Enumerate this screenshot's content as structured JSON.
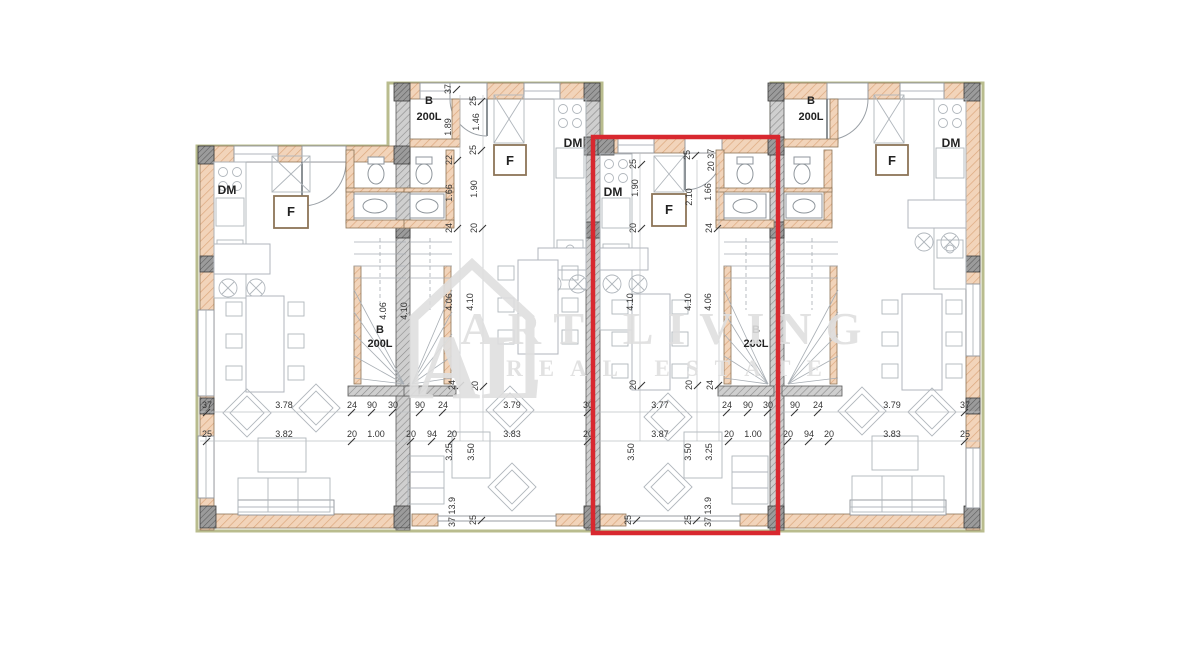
{
  "palette": {
    "highlight_red": "#d8282f",
    "wall_fill": "#f2d4ba",
    "wall_hatch": "#dca87e",
    "party_wall_gray": "#cfcfcf",
    "column_gray": "#9b9b9b",
    "olive_outline": "#b9bc8e",
    "dim_text": "#333333",
    "watermark": "#dfdfdf"
  },
  "watermark": {
    "line1": "ART LIVING",
    "line2": "REAL ESTATE",
    "monogram": "AL"
  },
  "highlight": {
    "label": "selected-unit",
    "color": "#d8282f"
  },
  "floorplan": {
    "room_labels": [
      {
        "t": "DM",
        "x": 227,
        "y": 194,
        "s": 12
      },
      {
        "t": "DM",
        "x": 573,
        "y": 147,
        "s": 12
      },
      {
        "t": "DM",
        "x": 613,
        "y": 196,
        "s": 12
      },
      {
        "t": "DM",
        "x": 951,
        "y": 147,
        "s": 12
      },
      {
        "t": "F",
        "x": 291,
        "y": 216,
        "s": 13
      },
      {
        "t": "F",
        "x": 510,
        "y": 165,
        "s": 13
      },
      {
        "t": "F",
        "x": 669,
        "y": 214,
        "s": 13
      },
      {
        "t": "F",
        "x": 892,
        "y": 165,
        "s": 13
      },
      {
        "t": "B",
        "x": 380,
        "y": 333,
        "s": 11
      },
      {
        "t": "200L",
        "x": 380,
        "y": 347,
        "s": 11
      },
      {
        "t": "B",
        "x": 429,
        "y": 104,
        "s": 11
      },
      {
        "t": "200L",
        "x": 429,
        "y": 120,
        "s": 11
      },
      {
        "t": "B",
        "x": 756,
        "y": 333,
        "s": 11
      },
      {
        "t": "200L",
        "x": 756,
        "y": 347,
        "s": 11
      },
      {
        "t": "B",
        "x": 811,
        "y": 104,
        "s": 11
      },
      {
        "t": "200L",
        "x": 811,
        "y": 120,
        "s": 11
      }
    ],
    "dims_h": [
      {
        "t": "37",
        "x": 207,
        "y": 408
      },
      {
        "t": "3.78",
        "x": 284,
        "y": 408
      },
      {
        "t": "24",
        "x": 352,
        "y": 408
      },
      {
        "t": "90",
        "x": 372,
        "y": 408
      },
      {
        "t": "30",
        "x": 393,
        "y": 408
      },
      {
        "t": "90",
        "x": 420,
        "y": 408
      },
      {
        "t": "24",
        "x": 443,
        "y": 408
      },
      {
        "t": "3.79",
        "x": 512,
        "y": 408
      },
      {
        "t": "30",
        "x": 588,
        "y": 408
      },
      {
        "t": "3.77",
        "x": 660,
        "y": 408
      },
      {
        "t": "24",
        "x": 727,
        "y": 408
      },
      {
        "t": "90",
        "x": 748,
        "y": 408
      },
      {
        "t": "30",
        "x": 768,
        "y": 408
      },
      {
        "t": "90",
        "x": 795,
        "y": 408
      },
      {
        "t": "24",
        "x": 818,
        "y": 408
      },
      {
        "t": "3.79",
        "x": 892,
        "y": 408
      },
      {
        "t": "37",
        "x": 965,
        "y": 408
      },
      {
        "t": "25",
        "x": 207,
        "y": 437
      },
      {
        "t": "3.82",
        "x": 284,
        "y": 437
      },
      {
        "t": "20",
        "x": 352,
        "y": 437
      },
      {
        "t": "1.00",
        "x": 376,
        "y": 437
      },
      {
        "t": "20",
        "x": 411,
        "y": 437
      },
      {
        "t": "94",
        "x": 432,
        "y": 437
      },
      {
        "t": "20",
        "x": 452,
        "y": 437
      },
      {
        "t": "3.83",
        "x": 512,
        "y": 437
      },
      {
        "t": "20",
        "x": 588,
        "y": 437
      },
      {
        "t": "3.87",
        "x": 660,
        "y": 437
      },
      {
        "t": "20",
        "x": 729,
        "y": 437
      },
      {
        "t": "1.00",
        "x": 753,
        "y": 437
      },
      {
        "t": "20",
        "x": 788,
        "y": 437
      },
      {
        "t": "94",
        "x": 809,
        "y": 437
      },
      {
        "t": "20",
        "x": 829,
        "y": 437
      },
      {
        "t": "3.83",
        "x": 892,
        "y": 437
      },
      {
        "t": "25",
        "x": 965,
        "y": 437
      }
    ],
    "dims_v": [
      {
        "t": "37",
        "x": 451,
        "y": 89
      },
      {
        "t": "25",
        "x": 476,
        "y": 101
      },
      {
        "t": "1.89",
        "x": 451,
        "y": 127
      },
      {
        "t": "1.46",
        "x": 479,
        "y": 122
      },
      {
        "t": "25",
        "x": 476,
        "y": 150
      },
      {
        "t": "22",
        "x": 452,
        "y": 160
      },
      {
        "t": "1.90",
        "x": 477,
        "y": 189
      },
      {
        "t": "1.66",
        "x": 452,
        "y": 193
      },
      {
        "t": "24",
        "x": 452,
        "y": 228
      },
      {
        "t": "20",
        "x": 477,
        "y": 228
      },
      {
        "t": "4.06",
        "x": 386,
        "y": 311
      },
      {
        "t": "4.10",
        "x": 407,
        "y": 311
      },
      {
        "t": "4.06",
        "x": 452,
        "y": 302
      },
      {
        "t": "4.10",
        "x": 473,
        "y": 302
      },
      {
        "t": "24",
        "x": 455,
        "y": 385
      },
      {
        "t": "20",
        "x": 478,
        "y": 386
      },
      {
        "t": "3.25",
        "x": 452,
        "y": 452
      },
      {
        "t": "3.50",
        "x": 474,
        "y": 452
      },
      {
        "t": "37 13.9",
        "x": 455,
        "y": 512
      },
      {
        "t": "25",
        "x": 476,
        "y": 520
      },
      {
        "t": "25",
        "x": 636,
        "y": 164
      },
      {
        "t": "1.90",
        "x": 638,
        "y": 188
      },
      {
        "t": "20",
        "x": 636,
        "y": 228
      },
      {
        "t": "4.10",
        "x": 633,
        "y": 302
      },
      {
        "t": "20",
        "x": 636,
        "y": 385
      },
      {
        "t": "3.50",
        "x": 634,
        "y": 452
      },
      {
        "t": "25",
        "x": 631,
        "y": 520
      },
      {
        "t": "25",
        "x": 690,
        "y": 155
      },
      {
        "t": "2.10",
        "x": 692,
        "y": 197
      },
      {
        "t": "20 37",
        "x": 714,
        "y": 160
      },
      {
        "t": "1.66",
        "x": 711,
        "y": 192
      },
      {
        "t": "24",
        "x": 712,
        "y": 228
      },
      {
        "t": "4.10",
        "x": 691,
        "y": 302
      },
      {
        "t": "4.06",
        "x": 711,
        "y": 302
      },
      {
        "t": "20",
        "x": 692,
        "y": 385
      },
      {
        "t": "24",
        "x": 713,
        "y": 385
      },
      {
        "t": "3.50",
        "x": 691,
        "y": 452
      },
      {
        "t": "3.25",
        "x": 712,
        "y": 452
      },
      {
        "t": "37 13.9",
        "x": 711,
        "y": 512
      },
      {
        "t": "25",
        "x": 691,
        "y": 520
      }
    ]
  }
}
